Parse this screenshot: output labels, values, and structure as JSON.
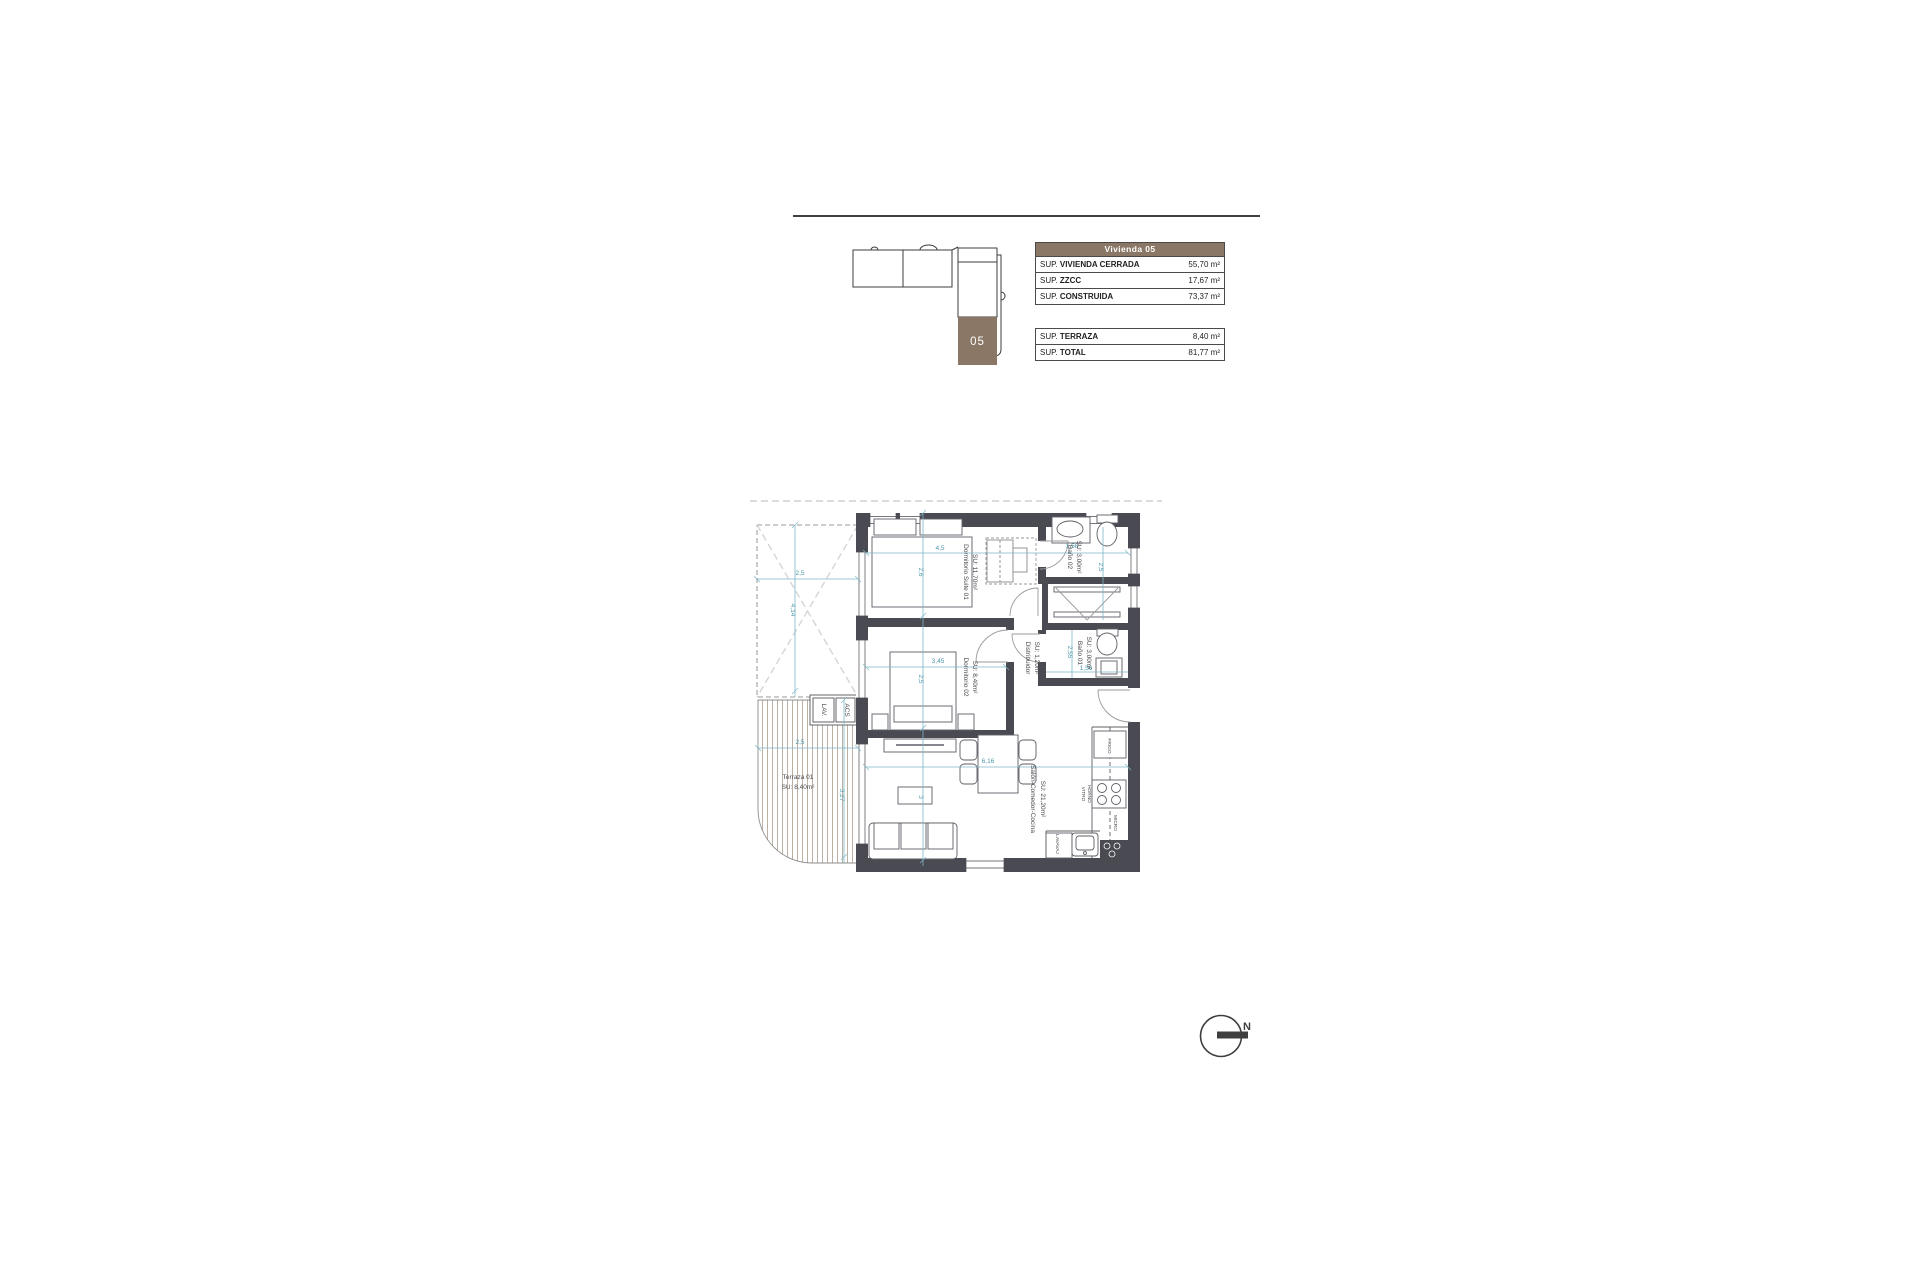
{
  "colors": {
    "accent_brown": "#8a7766",
    "wall": "#4a4a52",
    "dimension": "#7cb6c6"
  },
  "unit_locator": {
    "unit_label": "05"
  },
  "summary_tables": {
    "main": {
      "header": "Vivienda 05",
      "rows": [
        {
          "prefix": "SUP.",
          "name": "VIVIENDA CERRADA",
          "value": "55,70 m²"
        },
        {
          "prefix": "SUP.",
          "name": "ZZCC",
          "value": "17,67 m²"
        },
        {
          "prefix": "SUP.",
          "name": "CONSTRUIDA",
          "value": "73,37 m²"
        }
      ]
    },
    "extra": {
      "rows": [
        {
          "prefix": "SUP.",
          "name": "TERRAZA",
          "value": "8,40 m²"
        },
        {
          "prefix": "SUP.",
          "name": "TOTAL",
          "value": "81,77 m²"
        }
      ]
    }
  },
  "floorplan": {
    "rooms": {
      "suite": {
        "name": "Dormitorio Suite 01",
        "area": "SU: 11,70m²"
      },
      "bano02": {
        "name": "Baño 02",
        "area": "SU: 3,00m²"
      },
      "distribuidor": {
        "name": "Distribuidor",
        "area": "SU: 1,20m²"
      },
      "dorm02": {
        "name": "Dormitorio 02",
        "area": "SU: 8,40m²"
      },
      "bano01": {
        "name": "Baño 01",
        "area": "SU: 3,00m²"
      },
      "salon": {
        "name": "Salón-Comedor-Cocina",
        "area": "SU: 21,20m²"
      },
      "terraza": {
        "name": "Terraza 01",
        "area": "SU: 8,40m²"
      }
    },
    "dimensions": {
      "patio_w": "2,5",
      "patio_h": "4,14",
      "suite_w": "4,5",
      "suite_h": "2,6",
      "bano2_w": "1,56",
      "bano2_h": "2,5",
      "dorm2_w": "3,45",
      "dorm2_h": "2,5",
      "bano1_h": "2,55",
      "bano1_w": "1,56",
      "salon_w": "6,16",
      "salon_h": "3",
      "terraza_w": "2,5",
      "terraza_h": "3,27"
    },
    "kitchen_labels": {
      "frigo": "FRIGO",
      "vitro": "VITRO",
      "horno": "HORNO",
      "micro": "MICRO",
      "lavavaj": "LAVAVAJ"
    },
    "closet_labels": {
      "lav": "LAV.",
      "acs": "ACS"
    }
  },
  "compass": {
    "label": "N"
  }
}
